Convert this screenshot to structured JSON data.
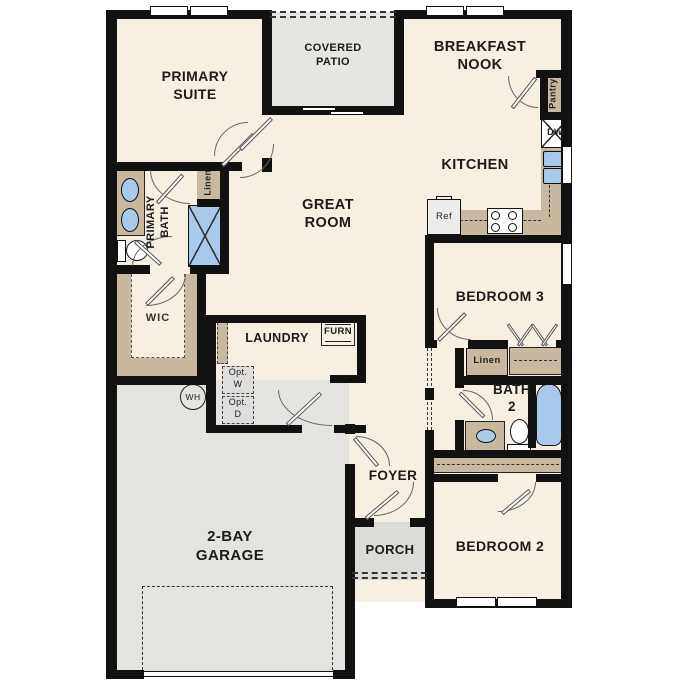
{
  "plan_title": "Single-story floor plan",
  "labels": {
    "primary_suite": "PRIMARY SUITE",
    "covered_patio": "COVERED PATIO",
    "breakfast_nook": "BREAKFAST NOOK",
    "kitchen": "KITCHEN",
    "great_room": "GREAT ROOM",
    "primary_bath": "PRIMARY BATH",
    "wic": "WIC",
    "laundry": "LAUNDRY",
    "bedroom3": "BEDROOM 3",
    "bath2": "BATH 2",
    "bedroom2": "BEDROOM 2",
    "foyer": "FOYER",
    "porch": "PORCH",
    "garage": "2-BAY GARAGE",
    "pantry": "Pantry",
    "linen_primary": "Linen",
    "linen_hall": "Linen",
    "dishwasher": "DW",
    "refrigerator": "Ref",
    "furnace": "FURN",
    "water_heater": "WH",
    "opt_washer": "Opt. W",
    "opt_dryer": "Opt. D"
  },
  "colors": {
    "wall": "#111111",
    "floor": "#f6efe2",
    "tan": "#c8b8a0",
    "garage": "#e4e3e0",
    "patio": "#e6e5e2",
    "porch": "#dcdbd7",
    "blue": "#a9c9ea",
    "boxgray": "#dedddc"
  }
}
